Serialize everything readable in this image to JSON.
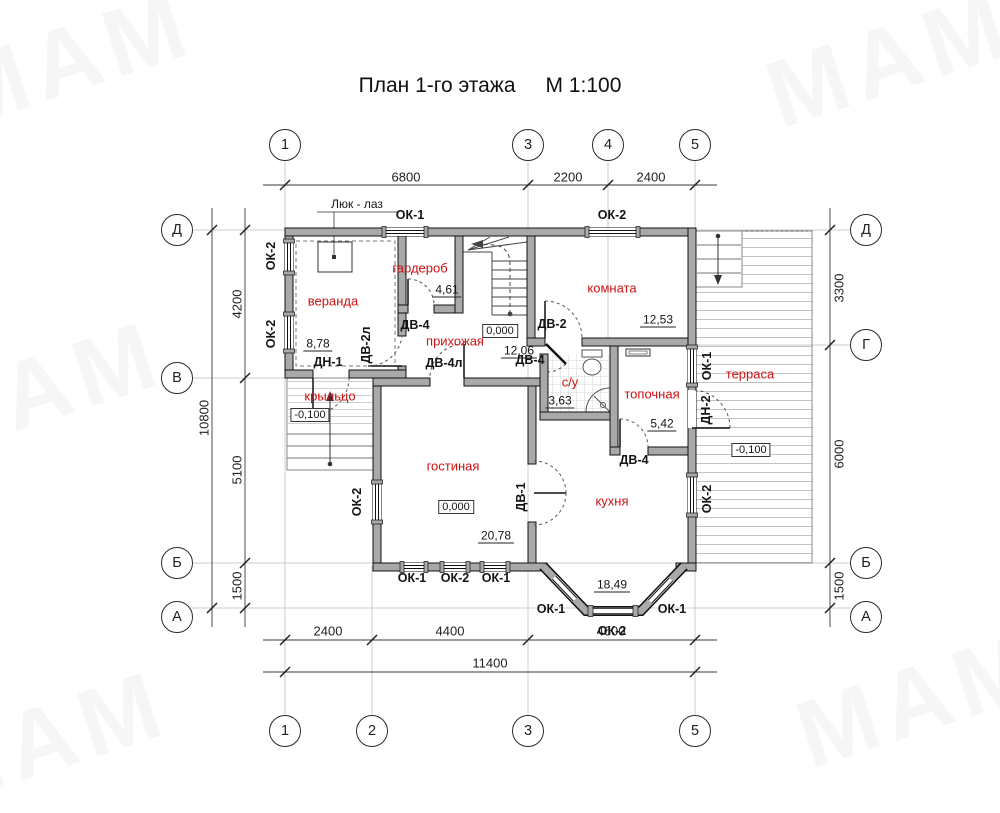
{
  "title": {
    "text": "План 1-го этажа",
    "scale": "М 1:100"
  },
  "watermark": {
    "text": "МАМ"
  },
  "axes": {
    "top": [
      "1",
      "3",
      "4",
      "5"
    ],
    "bottom": [
      "1",
      "2",
      "3",
      "5"
    ],
    "left": [
      "Д",
      "В",
      "Б",
      "А"
    ],
    "right": [
      "Д",
      "Г",
      "Б",
      "А"
    ]
  },
  "dimensions": {
    "top": [
      "6800",
      "2200",
      "2400"
    ],
    "bottom": [
      "2400",
      "4400",
      "4600"
    ],
    "bottom_total": "11400",
    "left": [
      "4200",
      "5100",
      "1500"
    ],
    "left_total": "10800",
    "right": [
      "3300",
      "6000",
      "1500"
    ]
  },
  "rooms": {
    "veranda": {
      "name": "веранда",
      "area": "8,78"
    },
    "garderob": {
      "name": "гардероб",
      "area": "4,61"
    },
    "komnata": {
      "name": "комната",
      "area": "12,53"
    },
    "prihozhaya": {
      "name": "прихожая",
      "area": "12,06"
    },
    "su": {
      "name": "с/у",
      "area": "3,63"
    },
    "topochnaya": {
      "name": "топочная",
      "area": "5,42"
    },
    "krylco": {
      "name": "крыльцо"
    },
    "gostinaya": {
      "name": "гостиная",
      "area": "20,78"
    },
    "kuhnya": {
      "name": "кухня",
      "area": "18,49"
    },
    "terrasa": {
      "name": "терраса"
    }
  },
  "elevations": {
    "zero": "0,000",
    "minus": "-0,100"
  },
  "openings": {
    "ok1": "ОК-1",
    "ok2": "ОК-2",
    "dv1": "ДВ-1",
    "dv2": "ДВ-2",
    "dv2l": "ДВ-2л",
    "dv4": "ДВ-4",
    "dv4l": "ДВ-4л",
    "dn1": "ДН-1",
    "dn2": "ДН-2"
  },
  "annotations": {
    "hatch": "Люк - лаз"
  },
  "colors": {
    "room_label": "#cc1111",
    "wall_fill": "#a9a9a9",
    "line": "#1a1a1a"
  }
}
